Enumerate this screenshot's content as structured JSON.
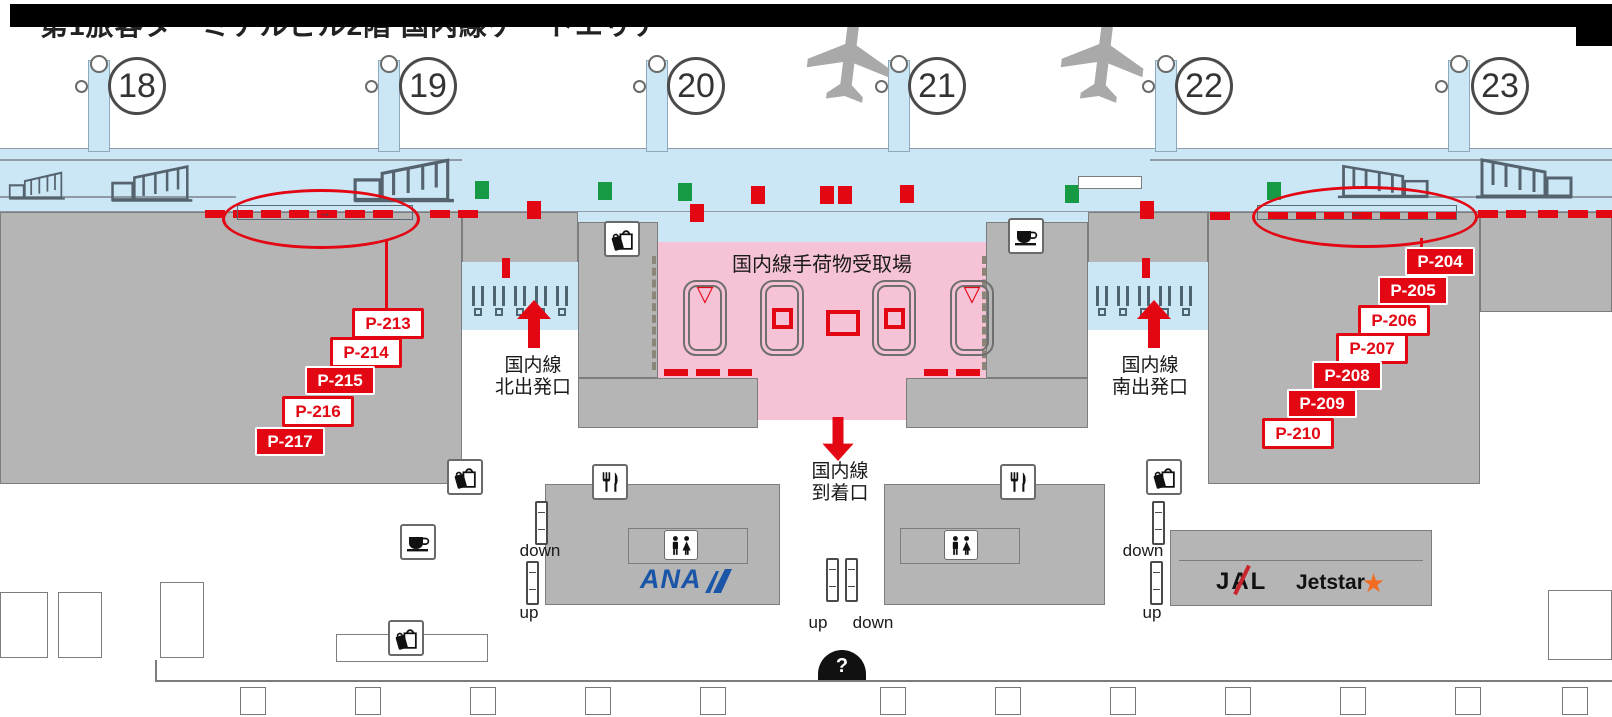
{
  "title": "第1旅客ターミナルビル2階 国内線ゲートエリア",
  "colors": {
    "red": "#e30613",
    "green": "#169a43",
    "blue_apron": "#cbe6f5",
    "pink": "#f6c3d6",
    "gray": "#b5b5b5",
    "ana_blue": "#1a55a8",
    "jetstar_orange": "#f26b21"
  },
  "gates": [
    {
      "number": "18",
      "circle_x": 137,
      "bridge_x": 88
    },
    {
      "number": "19",
      "circle_x": 428,
      "bridge_x": 378
    },
    {
      "number": "20",
      "circle_x": 696,
      "bridge_x": 646
    },
    {
      "number": "21",
      "circle_x": 937,
      "bridge_x": 888
    },
    {
      "number": "22",
      "circle_x": 1204,
      "bridge_x": 1155
    },
    {
      "number": "23",
      "circle_x": 1500,
      "bridge_x": 1448
    }
  ],
  "airplanes": [
    {
      "x": 806,
      "y": 12
    },
    {
      "x": 1060,
      "y": 12
    }
  ],
  "areas": {
    "baggage_claim": {
      "label": "国内線手荷物受取場"
    },
    "north_departure": {
      "line1": "国内線",
      "line2": "北出発口"
    },
    "south_departure": {
      "line1": "国内線",
      "line2": "南出発口"
    },
    "arrival": {
      "line1": "国内線",
      "line2": "到着口"
    }
  },
  "stand_labels": [
    {
      "label": "P-204",
      "x": 1405,
      "y": 247,
      "variant": "solid"
    },
    {
      "label": "P-205",
      "x": 1378,
      "y": 276,
      "variant": "solid"
    },
    {
      "label": "P-206",
      "x": 1358,
      "y": 305,
      "variant": "outline"
    },
    {
      "label": "P-207",
      "x": 1336,
      "y": 333,
      "variant": "outline"
    },
    {
      "label": "P-208",
      "x": 1312,
      "y": 361,
      "variant": "solid"
    },
    {
      "label": "P-209",
      "x": 1287,
      "y": 389,
      "variant": "solid"
    },
    {
      "label": "P-210",
      "x": 1262,
      "y": 418,
      "variant": "outline"
    },
    {
      "label": "P-213",
      "x": 352,
      "y": 308,
      "variant": "outline"
    },
    {
      "label": "P-214",
      "x": 330,
      "y": 337,
      "variant": "outline"
    },
    {
      "label": "P-215",
      "x": 305,
      "y": 366,
      "variant": "solid"
    },
    {
      "label": "P-216",
      "x": 282,
      "y": 396,
      "variant": "outline"
    },
    {
      "label": "P-217",
      "x": 255,
      "y": 427,
      "variant": "solid"
    }
  ],
  "apron_markers": [
    [
      "green",
      475,
      181
    ],
    [
      "red",
      527,
      201
    ],
    [
      "green",
      598,
      182
    ],
    [
      "green",
      678,
      183
    ],
    [
      "red",
      690,
      204
    ],
    [
      "red",
      751,
      186
    ],
    [
      "red",
      820,
      186
    ],
    [
      "red",
      838,
      186
    ],
    [
      "red",
      900,
      185
    ],
    [
      "green",
      1065,
      185
    ],
    [
      "red",
      1140,
      201
    ],
    [
      "green",
      1267,
      182
    ]
  ],
  "red_dashes": [
    [
      205,
      210
    ],
    [
      233,
      210
    ],
    [
      261,
      210
    ],
    [
      289,
      210
    ],
    [
      317,
      210
    ],
    [
      345,
      210
    ],
    [
      373,
      210
    ],
    [
      430,
      210
    ],
    [
      458,
      210
    ],
    [
      1210,
      212
    ],
    [
      1268,
      212
    ],
    [
      1296,
      212
    ],
    [
      1324,
      212
    ],
    [
      1352,
      212
    ],
    [
      1380,
      212
    ],
    [
      1408,
      212
    ],
    [
      1436,
      212
    ],
    [
      1478,
      210
    ],
    [
      1506,
      210
    ],
    [
      1538,
      210
    ],
    [
      1568,
      210
    ],
    [
      1596,
      210
    ]
  ],
  "pink_dashes": [
    [
      664,
      369
    ],
    [
      696,
      369
    ],
    [
      728,
      369
    ],
    [
      924,
      369
    ],
    [
      956,
      369
    ]
  ],
  "red_bars": [
    [
      502,
      258
    ],
    [
      1142,
      258
    ]
  ],
  "carousels": [
    {
      "x": 683,
      "symbol": "triangle"
    },
    {
      "x": 760,
      "symbol": "square"
    },
    {
      "x": 872,
      "symbol": "square"
    },
    {
      "x": 950,
      "symbol": "triangle"
    }
  ],
  "escalators": [
    {
      "label": "down",
      "icon_x": 535,
      "icon_y": 501,
      "label_x": 540,
      "label_y": 541
    },
    {
      "label": "up",
      "icon_x": 526,
      "icon_y": 561,
      "label_x": 529,
      "label_y": 603
    },
    {
      "label": "up",
      "icon_x": 826,
      "icon_y": 558,
      "label_x": 818,
      "label_y": 613
    },
    {
      "label": "down",
      "icon_x": 845,
      "icon_y": 558,
      "label_x": 873,
      "label_y": 613
    },
    {
      "label": "down",
      "icon_x": 1152,
      "icon_y": 501,
      "label_x": 1143,
      "label_y": 541
    },
    {
      "label": "up",
      "icon_x": 1150,
      "icon_y": 561,
      "label_x": 1152,
      "label_y": 603
    }
  ],
  "walkways": [
    {
      "x": 237,
      "y": 205,
      "w": 176,
      "arrow": "→"
    },
    {
      "x": 1257,
      "y": 205,
      "w": 200,
      "arrow": "←"
    }
  ],
  "icon_boxes": [
    {
      "type": "bag",
      "x": 604,
      "y": 221
    },
    {
      "type": "coffee",
      "x": 1008,
      "y": 218
    },
    {
      "type": "bag",
      "x": 447,
      "y": 459
    },
    {
      "type": "bag",
      "x": 1146,
      "y": 459
    },
    {
      "type": "restaurant",
      "x": 592,
      "y": 464
    },
    {
      "type": "restaurant",
      "x": 1000,
      "y": 464
    },
    {
      "type": "coffee",
      "x": 400,
      "y": 524
    },
    {
      "type": "bag",
      "x": 388,
      "y": 620
    },
    {
      "type": "restroom",
      "x": 664,
      "y": 530
    },
    {
      "type": "restroom",
      "x": 944,
      "y": 530
    }
  ],
  "security": {
    "north_x": 472,
    "south_x": 1096,
    "y": 286,
    "count": 5,
    "spacing": 21
  },
  "outline_boxes": [
    [
      0,
      592,
      48,
      66
    ],
    [
      58,
      592,
      44,
      66
    ],
    [
      160,
      582,
      44,
      76
    ],
    [
      1548,
      590,
      64,
      70
    ],
    [
      336,
      634,
      152,
      28
    ],
    [
      1078,
      176,
      64,
      13
    ]
  ],
  "bottom_counters": {
    "y": 687,
    "xs": [
      240,
      355,
      470,
      585,
      700,
      880,
      995,
      1110,
      1225,
      1340,
      1455,
      1562
    ]
  },
  "belt_loaders": [
    [
      8,
      170,
      58,
      32,
      0
    ],
    [
      110,
      163,
      84,
      42,
      0
    ],
    [
      352,
      156,
      104,
      50,
      0
    ],
    [
      1336,
      163,
      94,
      38,
      1
    ],
    [
      1474,
      156,
      100,
      46,
      1
    ]
  ],
  "logos": {
    "ana": "ANA",
    "jal": "JAL",
    "jetstar": "Jetstar"
  },
  "info": {
    "label": "?"
  }
}
